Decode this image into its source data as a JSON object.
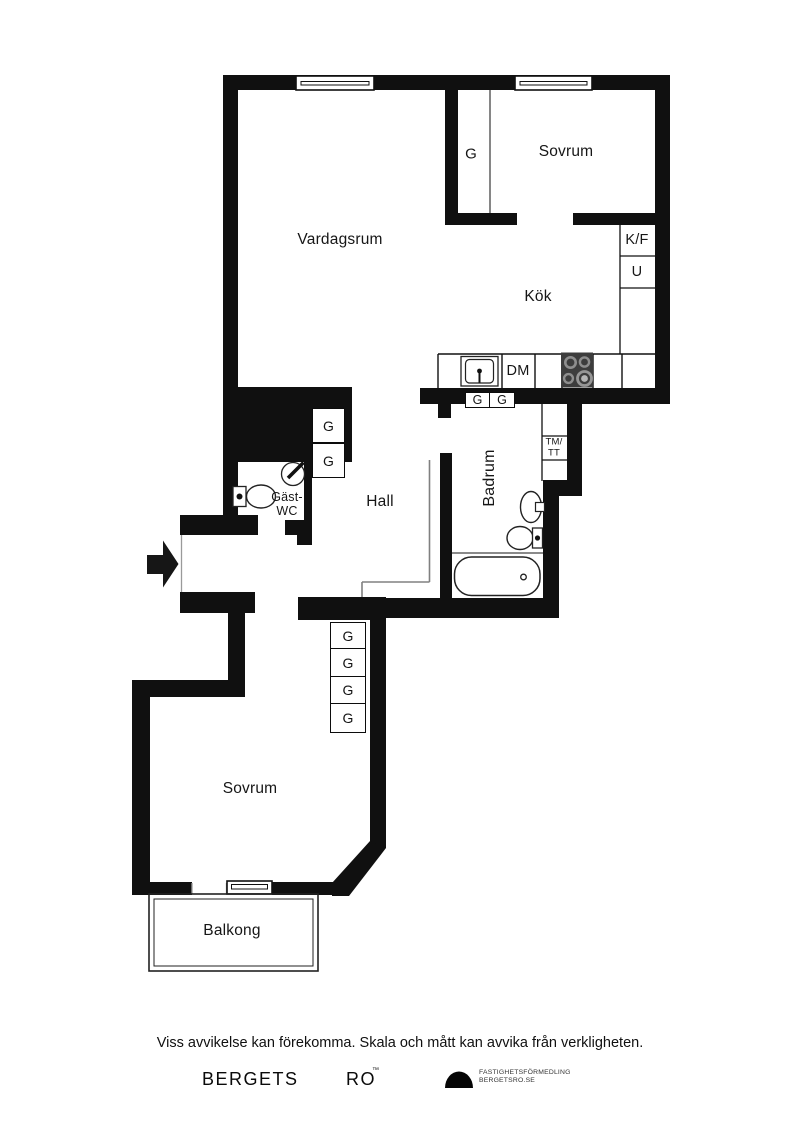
{
  "rooms": {
    "vardagsrum": "Vardagsrum",
    "sovrum_upper": "Sovrum",
    "kok": "Kök",
    "hall": "Hall",
    "badrum": "Badrum",
    "gast_wc_line1": "Gäst-",
    "gast_wc_line2": "WC",
    "sovrum_lower": "Sovrum",
    "balkong": "Balkong"
  },
  "labels": {
    "closet": "G",
    "fridge_freezer": "K/F",
    "oven": "U",
    "dishwasher": "DM",
    "washer_line1": "TM/",
    "washer_line2": "TT"
  },
  "icons": {
    "entry_arrow": "entry-arrow",
    "windows": "window-symbol",
    "stove": "stove-burners",
    "sink": "sink",
    "toilet": "toilet",
    "bathtub": "bathtub",
    "logo_dome": "dome-logo"
  },
  "colors": {
    "wall": "#101010",
    "stove_body": "#3d3d3d",
    "burner_ring": "#8e8e8e",
    "thin_line": "#808080"
  },
  "footer": {
    "disclaimer": "Viss avvikelse kan förekomma. Skala och mått kan avvika från verkligheten.",
    "brand_word1": "BERGETS",
    "brand_word2": "RO",
    "brand_tm": "™",
    "logo_line1": "FASTIGHETSFÖRMEDLING",
    "logo_line2": "BERGETSRO.SE"
  }
}
